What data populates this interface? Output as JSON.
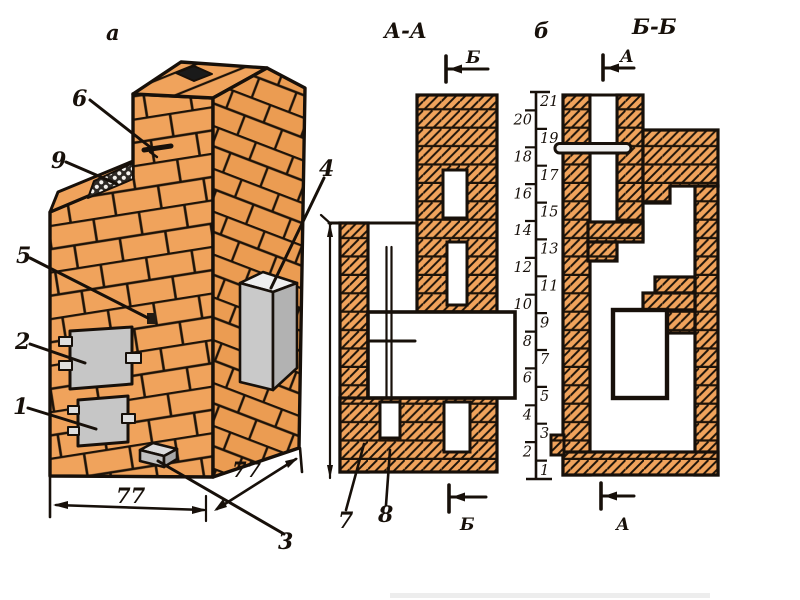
{
  "figure": {
    "view_perspective_label": "а",
    "section_aa_title": "А-А",
    "view_b_label": "б",
    "section_bb_title": "Б-Б"
  },
  "cut_markers": {
    "aa_top": "Б",
    "aa_bottom": "Б",
    "bb_top": "А",
    "bb_bottom": "А"
  },
  "callouts": {
    "c1": "1",
    "c2": "2",
    "c3": "3",
    "c4": "4",
    "c5": "5",
    "c6": "6",
    "c7": "7",
    "c8": "8",
    "c9": "9"
  },
  "dimensions": {
    "front_width": "77",
    "side_depth": "77"
  },
  "ruler": {
    "rows": [
      "1",
      "2",
      "3",
      "4",
      "5",
      "6",
      "7",
      "8",
      "9",
      "10",
      "11",
      "12",
      "13",
      "14",
      "15",
      "16",
      "17",
      "18",
      "19",
      "20",
      "21"
    ]
  },
  "colors": {
    "brick": "#f0a35c",
    "metal_gray": "#c6c6c6",
    "outline": "#17100a",
    "background": "#ffffff"
  }
}
